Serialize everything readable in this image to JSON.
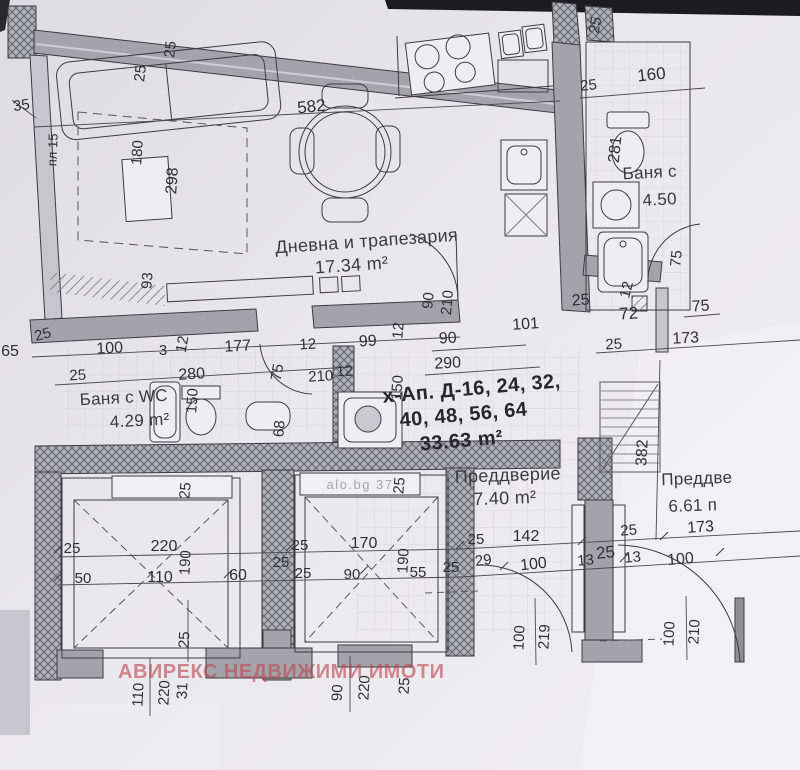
{
  "document": {
    "kind": "apartment floor plan scan",
    "colors": {
      "paper": "#e7e6ea",
      "wall_gray": "#a3a3a9",
      "hatch_gray": "#b0b0b6",
      "line": "#3c3c42",
      "watermark_red": "#bf4652"
    }
  },
  "watermark": {
    "text": "АВИРЕКС НЕДВИЖИМИ ИМОТИ"
  },
  "photo_watermark": {
    "text": "alo.bg  37",
    "x": 360,
    "y": 489
  },
  "apartment": {
    "lines": [
      {
        "t": "х-Ап. Д-16, 24, 32,",
        "x": 472,
        "y": 395
      },
      {
        "t": "40, 48, 56, 64",
        "x": 464,
        "y": 421
      },
      {
        "t": "33.63 m²",
        "x": 462,
        "y": 447
      }
    ],
    "r": -5
  },
  "rooms": [
    {
      "name": "Дневна и трапезария",
      "area": "17.34 m²",
      "x": 367,
      "y": 247,
      "ax": 352,
      "ay": 271,
      "r": -4,
      "s": 18
    },
    {
      "name": "Баня с WC",
      "area": "4.29 m²",
      "x": 124,
      "y": 403,
      "ax": 140,
      "ay": 426,
      "r": -3,
      "s": 17
    },
    {
      "name": "Баня с",
      "area": "4.50",
      "x": 650,
      "y": 178,
      "ax": 660,
      "ay": 205,
      "r": -3,
      "s": 17
    },
    {
      "name": "Преддверие",
      "area": "7.40 m²",
      "x": 508,
      "y": 481,
      "ax": 505,
      "ay": 504,
      "r": -2,
      "s": 18
    },
    {
      "name": "Преддве",
      "area": "6.61 п",
      "x": 697,
      "y": 484,
      "ax": 693,
      "ay": 511,
      "r": -2,
      "s": 17
    }
  ],
  "dimensions": [
    {
      "t": "35",
      "x": 22,
      "y": 110,
      "r": -8
    },
    {
      "t": "25",
      "x": 145,
      "y": 74,
      "r": -83
    },
    {
      "t": "25",
      "x": 175,
      "y": 50,
      "r": -83
    },
    {
      "t": "582",
      "x": 312,
      "y": 112,
      "r": -6,
      "s": 17
    },
    {
      "t": "пл 15",
      "x": 57,
      "y": 150,
      "r": -88,
      "s": 13
    },
    {
      "t": "180",
      "x": 142,
      "y": 153,
      "r": -86
    },
    {
      "t": "298",
      "x": 177,
      "y": 181,
      "r": -86,
      "s": 16
    },
    {
      "t": "93",
      "x": 152,
      "y": 281,
      "r": -86
    },
    {
      "t": "25",
      "x": 600,
      "y": 26,
      "r": -80
    },
    {
      "t": "25",
      "x": 589,
      "y": 90,
      "r": -6
    },
    {
      "t": "160",
      "x": 652,
      "y": 80,
      "r": -6,
      "s": 17
    },
    {
      "t": "281",
      "x": 620,
      "y": 150,
      "r": -84,
      "s": 16
    },
    {
      "t": "75",
      "x": 681,
      "y": 259,
      "r": -84
    },
    {
      "t": "65",
      "x": 10,
      "y": 356,
      "s": 16
    },
    {
      "t": "25",
      "x": 44,
      "y": 339,
      "r": -15
    },
    {
      "t": "100",
      "x": 110,
      "y": 353,
      "r": -3,
      "s": 16
    },
    {
      "t": "3",
      "x": 163,
      "y": 355
    },
    {
      "t": "12",
      "x": 187,
      "y": 345,
      "r": -80
    },
    {
      "t": "177",
      "x": 238,
      "y": 351,
      "r": -3,
      "s": 16
    },
    {
      "t": "12",
      "x": 308,
      "y": 349,
      "r": -3
    },
    {
      "t": "99",
      "x": 368,
      "y": 346,
      "r": -3,
      "s": 16
    },
    {
      "t": "25",
      "x": 78,
      "y": 380,
      "r": -3
    },
    {
      "t": "280",
      "x": 192,
      "y": 379,
      "r": -3,
      "s": 16
    },
    {
      "t": "75",
      "x": 282,
      "y": 373,
      "r": -80
    },
    {
      "t": "210",
      "x": 321,
      "y": 381,
      "r": -3
    },
    {
      "t": "12",
      "x": 345,
      "y": 376,
      "r": -3
    },
    {
      "t": "150",
      "x": 197,
      "y": 401,
      "r": -86
    },
    {
      "t": "68",
      "x": 284,
      "y": 429,
      "r": -86
    },
    {
      "t": "150",
      "x": 402,
      "y": 388,
      "r": -85
    },
    {
      "t": "90",
      "x": 433,
      "y": 301,
      "r": -85
    },
    {
      "t": "210",
      "x": 452,
      "y": 303,
      "r": -85
    },
    {
      "t": "12",
      "x": 403,
      "y": 331,
      "r": -85
    },
    {
      "t": "101",
      "x": 526,
      "y": 329,
      "r": -4,
      "s": 16
    },
    {
      "t": "90",
      "x": 448,
      "y": 343,
      "r": -3,
      "s": 16
    },
    {
      "t": "25",
      "x": 581,
      "y": 305,
      "r": -4,
      "s": 16
    },
    {
      "t": "12",
      "x": 631,
      "y": 291,
      "r": -75
    },
    {
      "t": "72",
      "x": 629,
      "y": 319,
      "r": -4,
      "s": 17
    },
    {
      "t": "75",
      "x": 701,
      "y": 311,
      "r": -4,
      "s": 16
    },
    {
      "t": "25",
      "x": 614,
      "y": 349,
      "r": -3
    },
    {
      "t": "173",
      "x": 686,
      "y": 343,
      "r": -3,
      "s": 16
    },
    {
      "t": "290",
      "x": 448,
      "y": 368,
      "r": -3,
      "s": 16
    },
    {
      "t": "382",
      "x": 647,
      "y": 453,
      "r": -87,
      "s": 16
    },
    {
      "t": "25",
      "x": 190,
      "y": 491,
      "r": -85
    },
    {
      "t": "25",
      "x": 404,
      "y": 486,
      "r": -85
    },
    {
      "t": "25",
      "x": 72,
      "y": 553
    },
    {
      "t": "220",
      "x": 164,
      "y": 551,
      "s": 16
    },
    {
      "t": "190",
      "x": 190,
      "y": 563,
      "r": -87
    },
    {
      "t": "50",
      "x": 83,
      "y": 583
    },
    {
      "t": "110",
      "x": 160,
      "y": 582,
      "s": 16
    },
    {
      "t": "60",
      "x": 238,
      "y": 580,
      "s": 16
    },
    {
      "t": "25",
      "x": 281,
      "y": 567
    },
    {
      "t": "25",
      "x": 300,
      "y": 550
    },
    {
      "t": "170",
      "x": 364,
      "y": 548,
      "s": 16
    },
    {
      "t": "190",
      "x": 408,
      "y": 561,
      "r": -87
    },
    {
      "t": "25",
      "x": 303,
      "y": 578
    },
    {
      "t": "90",
      "x": 352,
      "y": 579
    },
    {
      "t": "55",
      "x": 418,
      "y": 577
    },
    {
      "t": "25",
      "x": 451,
      "y": 572
    },
    {
      "t": "25",
      "x": 476,
      "y": 544
    },
    {
      "t": "142",
      "x": 526,
      "y": 541,
      "s": 16
    },
    {
      "t": "29",
      "x": 484,
      "y": 565,
      "r": -8
    },
    {
      "t": "100",
      "x": 534,
      "y": 569,
      "r": -6,
      "s": 16
    },
    {
      "t": "13",
      "x": 586,
      "y": 565,
      "r": -5
    },
    {
      "t": "25",
      "x": 606,
      "y": 558,
      "r": -5,
      "s": 17
    },
    {
      "t": "13",
      "x": 633,
      "y": 562,
      "r": -5
    },
    {
      "t": "100",
      "x": 681,
      "y": 564,
      "r": -5,
      "s": 16
    },
    {
      "t": "25",
      "x": 629,
      "y": 535,
      "r": -4
    },
    {
      "t": "173",
      "x": 701,
      "y": 532,
      "r": -4,
      "s": 16
    },
    {
      "t": "100",
      "x": 524,
      "y": 638,
      "r": -87
    },
    {
      "t": "219",
      "x": 549,
      "y": 637,
      "r": -87
    },
    {
      "t": "100",
      "x": 674,
      "y": 634,
      "r": -87
    },
    {
      "t": "210",
      "x": 699,
      "y": 632,
      "r": -87
    },
    {
      "t": "25",
      "x": 189,
      "y": 640,
      "r": -87
    },
    {
      "t": "110",
      "x": 143,
      "y": 695,
      "r": -87
    },
    {
      "t": "220",
      "x": 169,
      "y": 693,
      "r": -87
    },
    {
      "t": "31",
      "x": 187,
      "y": 691,
      "r": -87
    },
    {
      "t": "90",
      "x": 342,
      "y": 693,
      "r": -87
    },
    {
      "t": "220",
      "x": 369,
      "y": 688,
      "r": -87
    },
    {
      "t": "25",
      "x": 409,
      "y": 686,
      "r": -87
    }
  ]
}
